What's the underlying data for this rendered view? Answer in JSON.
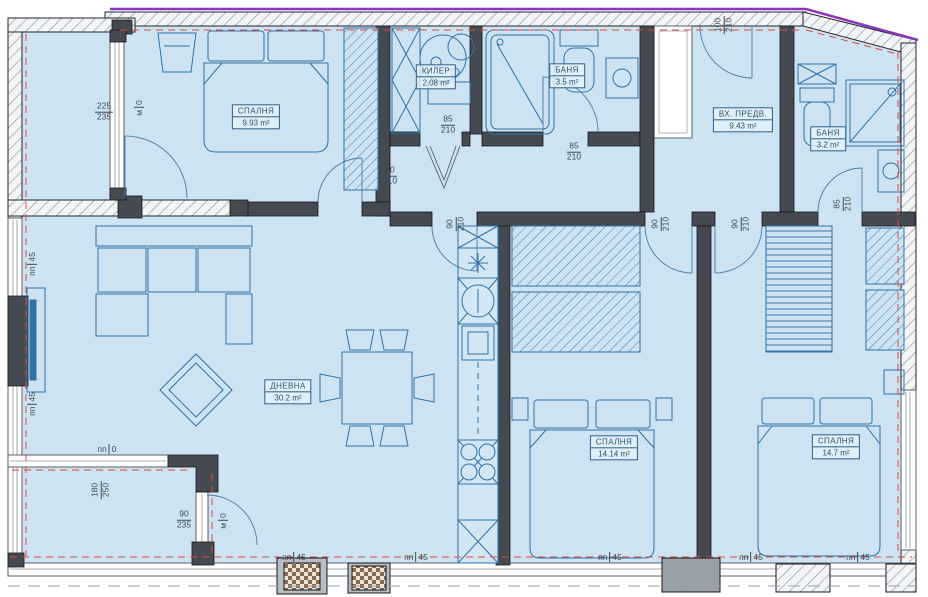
{
  "title": "Apartment floor plan",
  "colors": {
    "floor": "#cde3f1",
    "wall_dark": "#454a52",
    "furniture": "#2f72a8",
    "accent_red": "#e0483f",
    "accent_purple": "#8a35bd"
  },
  "rooms": [
    {
      "id": "bedroom-1",
      "name": "СПАЛНЯ",
      "area": "9.93 m²"
    },
    {
      "id": "closet",
      "name": "КИЛЕР",
      "area": "2.08 m²"
    },
    {
      "id": "bath-1",
      "name": "БАНЯ",
      "area": "3.5 m²"
    },
    {
      "id": "entry",
      "name": "ВХ. ПРЕДВ.",
      "area": "9.43 m²"
    },
    {
      "id": "bath-2",
      "name": "БАНЯ",
      "area": "3.2 m²"
    },
    {
      "id": "living",
      "name": "ДНЕВНА",
      "area": "30.2 m²"
    },
    {
      "id": "bedroom-2",
      "name": "СПАЛНЯ",
      "area": "14.14 m²"
    },
    {
      "id": "bedroom-3",
      "name": "СПАЛНЯ",
      "area": "14.7 m²"
    }
  ],
  "dims": {
    "window_terrace": {
      "top": "225",
      "bottom": "235"
    },
    "door_bedroom1": {
      "top": "90",
      "bottom": "210"
    },
    "door_closet": {
      "top": "85",
      "bottom": "210"
    },
    "door_bath1": {
      "top": "85",
      "bottom": "210"
    },
    "door_entrance": {
      "top": "100",
      "bottom": "210"
    },
    "door_living": {
      "top": "90",
      "bottom": "210"
    },
    "door_bedroom2": {
      "top": "90",
      "bottom": "210"
    },
    "door_bedroom3": {
      "top": "90",
      "bottom": "210"
    },
    "door_bath2": {
      "top": "85",
      "bottom": "210"
    },
    "terrace_door": {
      "top": "180",
      "bottom": "250"
    },
    "window_bottom": {
      "top": "90",
      "bottom": "235"
    }
  },
  "sills": {
    "p45a": "пп",
    "p45b": "45",
    "p0a": "пп",
    "p0b": "0",
    "m0a": "м",
    "m0b": "0"
  }
}
